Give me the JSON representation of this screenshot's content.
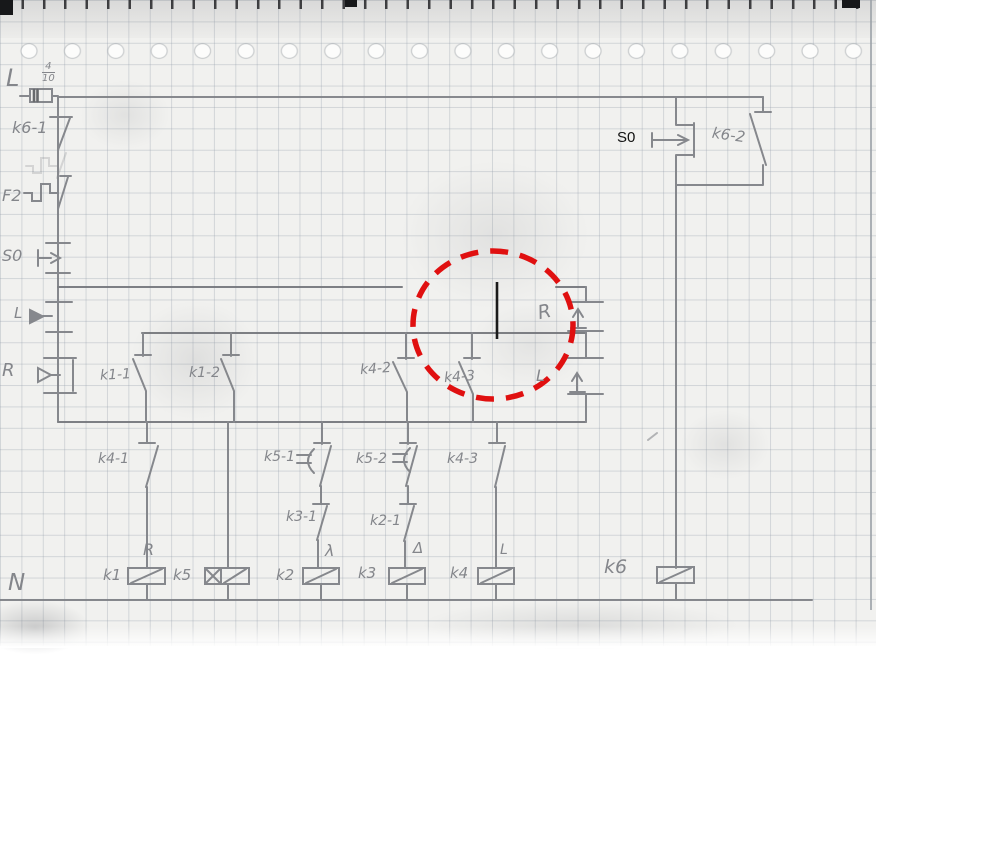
{
  "colors": {
    "pencil_gray": "#84868b",
    "highlight_red": "#e01010",
    "added_line_black": "#1a1a1a",
    "typed_text_black": "#111111"
  },
  "power": {
    "phase_label": "L",
    "neutral_label": "N",
    "fuse_rating_num": "4",
    "fuse_rating_den": "10"
  },
  "left_rail": {
    "k6_aux_contact": "k6-1",
    "overload_relay": "F2",
    "stop_button": "S0",
    "left_button": "L",
    "right_button": "R"
  },
  "row1_contacts": {
    "k1_1": "k1-1",
    "k1_2": "k1-2",
    "k4_2": "k4-2",
    "k4_3": "k4-3"
  },
  "right_buttons": {
    "reverse": "R",
    "forward": "L"
  },
  "start_block": {
    "typed_label": "S0",
    "latch_contact": "k6-2"
  },
  "row2_contacts": {
    "k4_1": "k4-1",
    "k5_1": "k5-1",
    "k5_2": "k5-2",
    "k4_3": "k4-3",
    "k3_1": "k3-1",
    "k2_1": "k2-1"
  },
  "coils": {
    "k1": {
      "name": "k1",
      "tag": "R"
    },
    "k5": {
      "name": "k5",
      "tag": ""
    },
    "k2": {
      "name": "k2",
      "tag": "λ"
    },
    "k3": {
      "name": "k3",
      "tag": "Δ"
    },
    "k4": {
      "name": "k4",
      "tag": "L"
    },
    "k6": {
      "name": "k6",
      "tag": ""
    }
  }
}
